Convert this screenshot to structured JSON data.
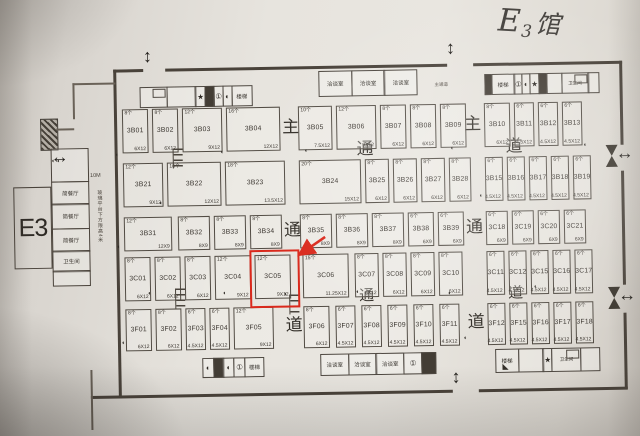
{
  "photo": {
    "handwritten_title": "E3馆"
  },
  "hall": {
    "big_label": "E3"
  },
  "annex": {
    "rooms": [
      "简餐厅",
      "简餐厅",
      "简餐厅",
      "卫生间"
    ],
    "height_note": "玻璃平台下方限高4米",
    "dimension_label": "10M"
  },
  "aisle_labels": {
    "vertical_left": [
      "主",
      "通",
      "道"
    ],
    "vertical_right": [
      "主",
      "通",
      "道"
    ],
    "horizontal_upper": [
      "通",
      "道"
    ],
    "horizontal_lower": [
      "通",
      "道"
    ],
    "entrance_label": "主通道"
  },
  "facilities": {
    "stairs_label": "楼梯",
    "meeting_room_label": "洽谈室",
    "restroom_label": "卫生间"
  },
  "legend_symbols": {
    "star": "★",
    "circle_one": "①",
    "half_circle": "◐",
    "arrow_h": "↔",
    "arrow_v": "↕",
    "corner_triangle": "◣"
  },
  "highlight": {
    "booth_id": "3C05",
    "color": "#da291c"
  },
  "booth_rows": [
    {
      "name": "row-1",
      "booths": [
        {
          "id": "3B01",
          "count": "8个",
          "size": "6X12"
        },
        {
          "id": "3B02",
          "count": "8个",
          "size": "6X12"
        },
        {
          "id": "3B03",
          "count": "12个",
          "size": "9X12"
        },
        {
          "id": "3B04",
          "count": "16个",
          "size": "12X12"
        },
        {
          "id": "3B05",
          "count": "10个",
          "size": "7.5X12"
        },
        {
          "id": "3B06",
          "count": "12个",
          "size": "9X12"
        },
        {
          "id": "3B07",
          "count": "8个",
          "size": "6X12"
        },
        {
          "id": "3B08",
          "count": "8个",
          "size": "6X12"
        },
        {
          "id": "3B09",
          "count": "8个",
          "size": "6X12"
        },
        {
          "id": "3B10",
          "count": "8个",
          "size": "6X12"
        },
        {
          "id": "3B11",
          "count": "6个",
          "size": "4.5X12"
        },
        {
          "id": "3B12",
          "count": "6个",
          "size": "4.5X12"
        },
        {
          "id": "3B13",
          "count": "6个",
          "size": "4.5X12"
        }
      ]
    },
    {
      "name": "row-2",
      "booths": [
        {
          "id": "3B21",
          "count": "12个",
          "size": "9X12"
        },
        {
          "id": "3B22",
          "count": "16个",
          "size": "12X12"
        },
        {
          "id": "3B23",
          "count": "18个",
          "size": "13.5X12"
        },
        {
          "id": "3B24",
          "count": "20个",
          "size": "15X12"
        },
        {
          "id": "3B25",
          "count": "8个",
          "size": "6X12"
        },
        {
          "id": "3B26",
          "count": "8个",
          "size": "6X12"
        },
        {
          "id": "3B27",
          "count": "8个",
          "size": "6X12"
        },
        {
          "id": "3B28",
          "count": "8个",
          "size": "6X12"
        },
        {
          "id": "3B15",
          "count": "6个",
          "size": "4.5X12"
        },
        {
          "id": "3B16",
          "count": "6个",
          "size": "4.5X12"
        },
        {
          "id": "3B17",
          "count": "6个",
          "size": "4.5X12"
        },
        {
          "id": "3B18",
          "count": "6个",
          "size": "4.5X12"
        },
        {
          "id": "3B19",
          "count": "6个",
          "size": "4.5X12"
        }
      ]
    },
    {
      "name": "row-3",
      "booths": [
        {
          "id": "3B31",
          "count": "12个",
          "size": "12X9"
        },
        {
          "id": "3B32",
          "count": "8个",
          "size": "8X9"
        },
        {
          "id": "3B33",
          "count": "8个",
          "size": "8X9"
        },
        {
          "id": "3B34",
          "count": "8个",
          "size": "8X9"
        },
        {
          "id": "3B35",
          "count": "8个",
          "size": "8X9"
        },
        {
          "id": "3B36",
          "count": "8个",
          "size": "8X9"
        },
        {
          "id": "3B37",
          "count": "8个",
          "size": "8X9"
        },
        {
          "id": "3B38",
          "count": "6个",
          "size": "6X9"
        },
        {
          "id": "3B39",
          "count": "6个",
          "size": "6X9"
        },
        {
          "id": "3C18",
          "count": "6个",
          "size": "6X9"
        },
        {
          "id": "3C19",
          "count": "6个",
          "size": "6X9"
        },
        {
          "id": "3C20",
          "count": "6个",
          "size": "6X9"
        },
        {
          "id": "3C21",
          "count": "6个",
          "size": "6X9"
        }
      ]
    },
    {
      "name": "row-4",
      "booths": [
        {
          "id": "3C01",
          "count": "8个",
          "size": "6X12"
        },
        {
          "id": "3C02",
          "count": "8个",
          "size": "6X12"
        },
        {
          "id": "3C03",
          "count": "8个",
          "size": "6X12"
        },
        {
          "id": "3C04",
          "count": "12个",
          "size": "9X12"
        },
        {
          "id": "3C05",
          "count": "12个",
          "size": "9X12"
        },
        {
          "id": "3C06",
          "count": "15个",
          "size": "11.25X12"
        },
        {
          "id": "3C07",
          "count": "8个",
          "size": "6X12"
        },
        {
          "id": "3C08",
          "count": "8个",
          "size": "6X12"
        },
        {
          "id": "3C09",
          "count": "8个",
          "size": "6X12"
        },
        {
          "id": "3C10",
          "count": "8个",
          "size": "6X12"
        },
        {
          "id": "3C11",
          "count": "6个",
          "size": "4.5X12"
        },
        {
          "id": "3C12",
          "count": "6个",
          "size": "4.5X12"
        },
        {
          "id": "3C15",
          "count": "6个",
          "size": "4.5X12"
        },
        {
          "id": "3C16",
          "count": "6个",
          "size": "4.5X12"
        },
        {
          "id": "3C17",
          "count": "6个",
          "size": "4.5X12"
        }
      ]
    },
    {
      "name": "row-5",
      "booths": [
        {
          "id": "3F01",
          "count": "8个",
          "size": "6X12"
        },
        {
          "id": "3F02",
          "count": "8个",
          "size": "6X12"
        },
        {
          "id": "3F03",
          "count": "6个",
          "size": "4.5X12"
        },
        {
          "id": "3F04",
          "count": "6个",
          "size": "4.5X12"
        },
        {
          "id": "3F05",
          "count": "12个",
          "size": "9X12"
        },
        {
          "id": "3F06",
          "count": "8个",
          "size": "6X12"
        },
        {
          "id": "3F07",
          "count": "6个",
          "size": "4.5X12"
        },
        {
          "id": "3F08",
          "count": "6个",
          "size": "4.5X12"
        },
        {
          "id": "3F09",
          "count": "6个",
          "size": "4.5X12"
        },
        {
          "id": "3F10",
          "count": "6个",
          "size": "4.5X12"
        },
        {
          "id": "3F11",
          "count": "6个",
          "size": "4.5X12"
        },
        {
          "id": "3F12",
          "count": "6个",
          "size": "4.5X12"
        },
        {
          "id": "3F15",
          "count": "6个",
          "size": "4.5X12"
        },
        {
          "id": "3F16",
          "count": "6个",
          "size": "4.5X12"
        },
        {
          "id": "3F17",
          "count": "6个",
          "size": "4.5X12"
        },
        {
          "id": "3F18",
          "count": "6个",
          "size": "4.5X12"
        }
      ]
    }
  ]
}
